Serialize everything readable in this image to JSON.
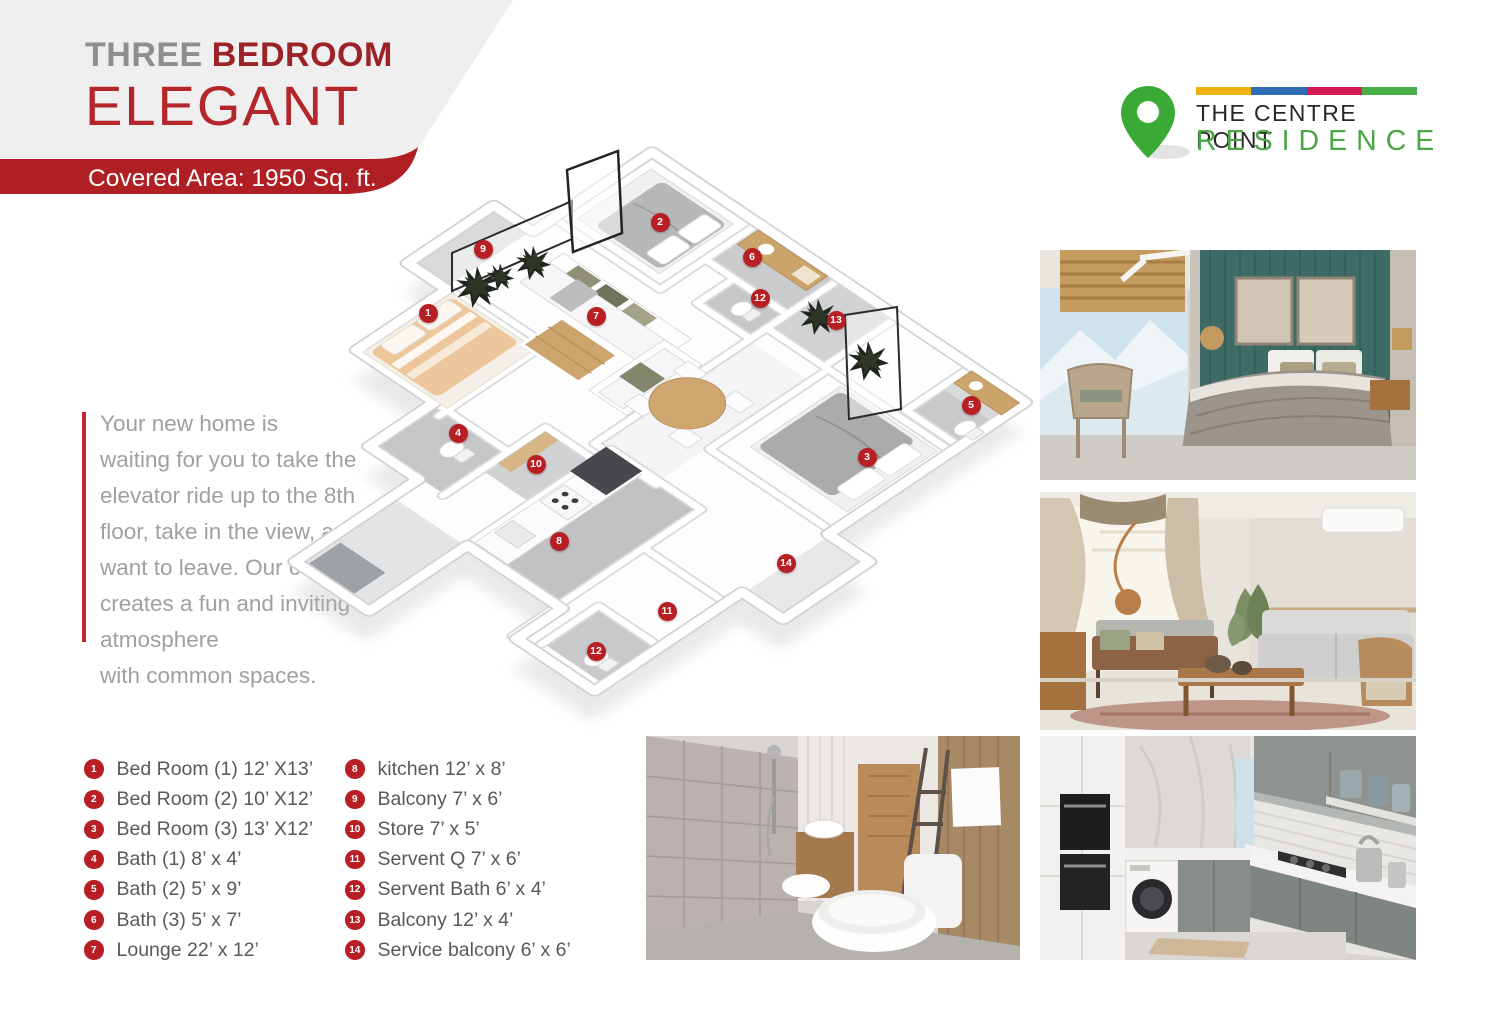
{
  "header": {
    "title_part1": "THREE",
    "title_part2": "BEDROOM",
    "title_line2": "ELEGANT",
    "covered_area": "Covered Area: 1950 Sq. ft."
  },
  "logo": {
    "line1": "THE CENTRE POINT",
    "line2": "RESIDENCE",
    "bar_colors": [
      "#eeb211",
      "#2e6cb3",
      "#d31a55",
      "#48ad47"
    ],
    "pin_color": "#3aa935",
    "residence_color": "#4aa746"
  },
  "intro": {
    "text": "Your new home is\nwaiting for you to take the\nelevator ride up to the 8th\nfloor, take in the view, and never\nwant to leave. Our community\ncreates a fun and inviting atmosphere\nwith common spaces."
  },
  "legend": {
    "column1": [
      {
        "num": "1",
        "label": "Bed Room (1) 12’ X13’"
      },
      {
        "num": "2",
        "label": "Bed Room (2) 10’ X12’"
      },
      {
        "num": "3",
        "label": "Bed Room (3) 13’ X12’"
      },
      {
        "num": "4",
        "label": "Bath (1) 8’ x 4’"
      },
      {
        "num": "5",
        "label": "Bath (2) 5’ x 9’"
      },
      {
        "num": "6",
        "label": "Bath (3) 5’ x 7’"
      },
      {
        "num": "7",
        "label": "Lounge 22’ x 12’"
      }
    ],
    "column2": [
      {
        "num": "8",
        "label": "kitchen 12’ x 8’"
      },
      {
        "num": "9",
        "label": "Balcony 7’ x 6’"
      },
      {
        "num": "10",
        "label": "Store 7’ x 5’"
      },
      {
        "num": "11",
        "label": "Servent Q 7’ x 6’"
      },
      {
        "num": "12",
        "label": "Servent Bath 6’ x 4’"
      },
      {
        "num": "13",
        "label": "Balcony 12’ x 4’"
      },
      {
        "num": "14",
        "label": "Service balcony 6’ x 6’"
      }
    ]
  },
  "floor_plan": {
    "markers": [
      {
        "num": "1",
        "x": 428,
        "y": 313
      },
      {
        "num": "2",
        "x": 660,
        "y": 222
      },
      {
        "num": "3",
        "x": 867,
        "y": 457
      },
      {
        "num": "4",
        "x": 458,
        "y": 433
      },
      {
        "num": "5",
        "x": 971,
        "y": 405
      },
      {
        "num": "6",
        "x": 752,
        "y": 257
      },
      {
        "num": "7",
        "x": 596,
        "y": 316
      },
      {
        "num": "8",
        "x": 559,
        "y": 541
      },
      {
        "num": "9",
        "x": 483,
        "y": 249
      },
      {
        "num": "10",
        "x": 536,
        "y": 464
      },
      {
        "num": "11",
        "x": 667,
        "y": 611
      },
      {
        "num": "12",
        "x": 760,
        "y": 298
      },
      {
        "num": "12",
        "x": 596,
        "y": 651
      },
      {
        "num": "13",
        "x": 836,
        "y": 320
      },
      {
        "num": "14",
        "x": 786,
        "y": 563
      }
    ]
  },
  "photos": [
    "bedroom-interior",
    "living-room-interior",
    "bathroom-interior",
    "kitchen-interior"
  ],
  "colors": {
    "accent_red": "#b5262b",
    "banner_red": "#b01f24",
    "marker_red": "#b71f24",
    "title_gray": "#8e8e90",
    "legend_text": "#58595c"
  }
}
